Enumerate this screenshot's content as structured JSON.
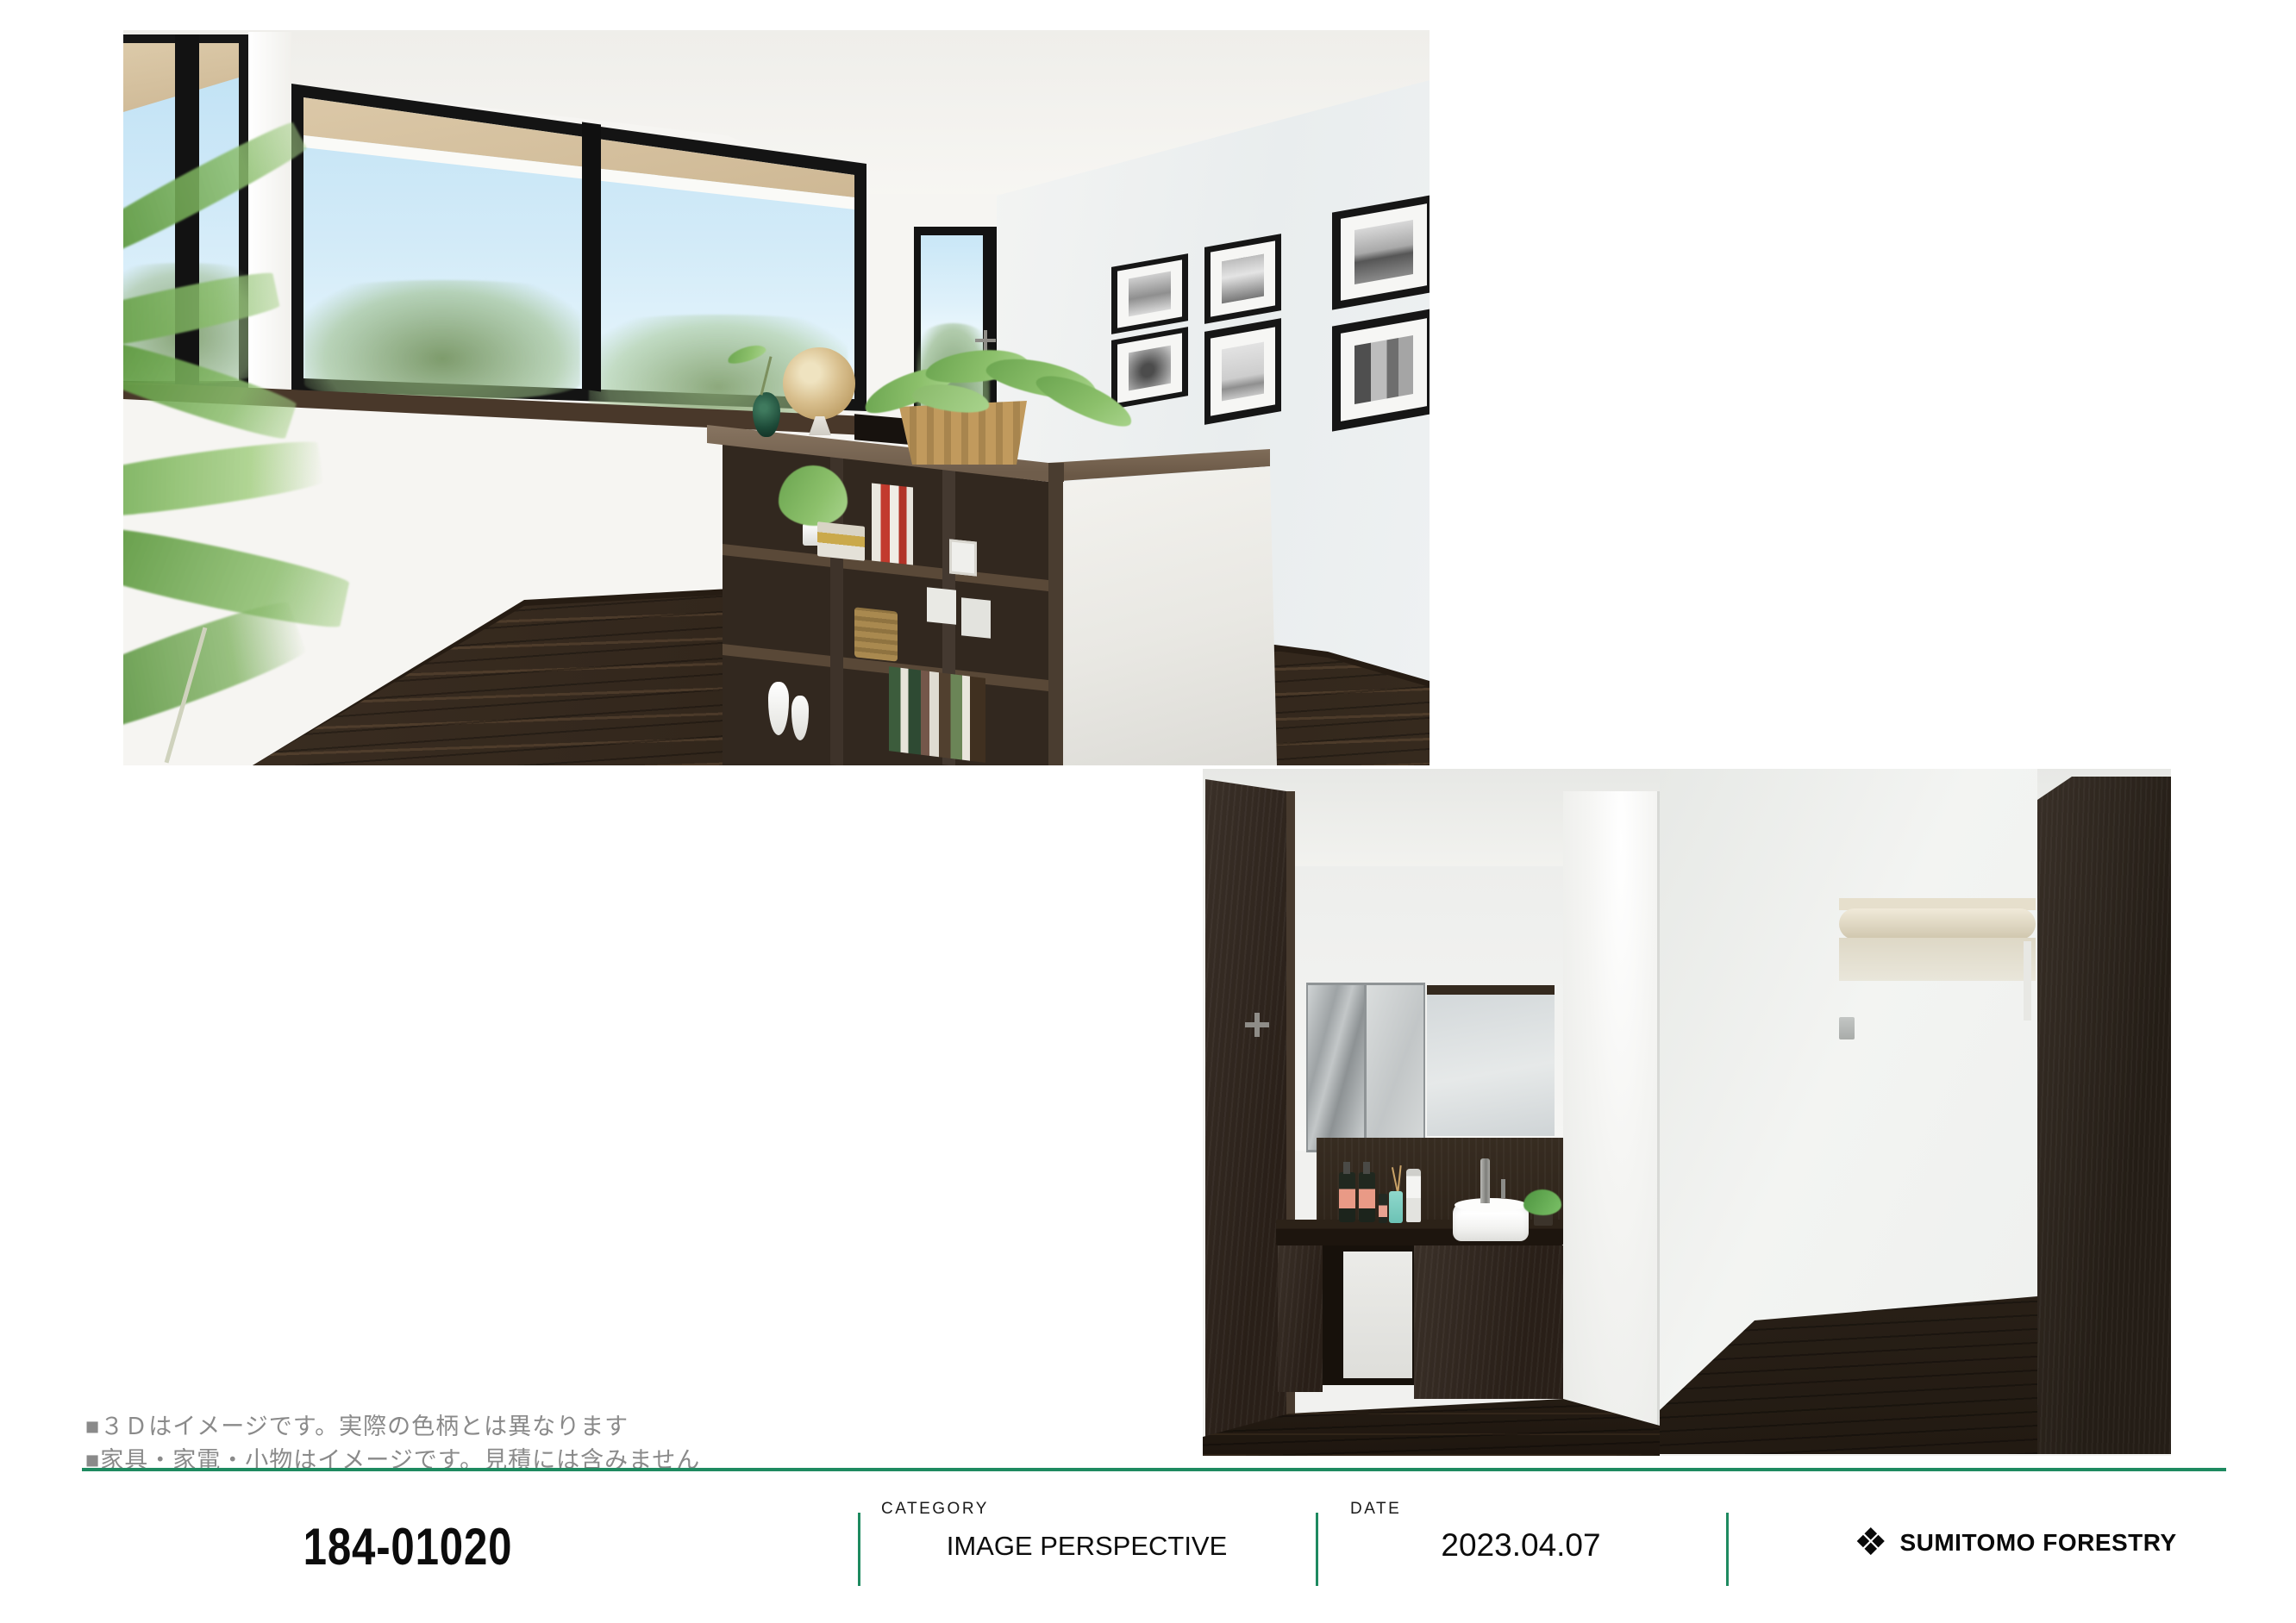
{
  "footer": {
    "disclaimer_lines": [
      "■３Ｄはイメージです。実際の色柄とは異なります",
      "■家具・家電・小物はイメージです。見積には含みません"
    ],
    "plan_number": "184-01020",
    "category": {
      "label": "CATEGORY",
      "value": "IMAGE PERSPECTIVE"
    },
    "date": {
      "label": "DATE",
      "value": "2023.04.07"
    },
    "brand": {
      "mark": "❖",
      "name": "SUMITOMO FORESTRY"
    },
    "colors": {
      "accent_green": "#1e8a60",
      "disclaimer_gray": "#8a8a8a"
    }
  }
}
